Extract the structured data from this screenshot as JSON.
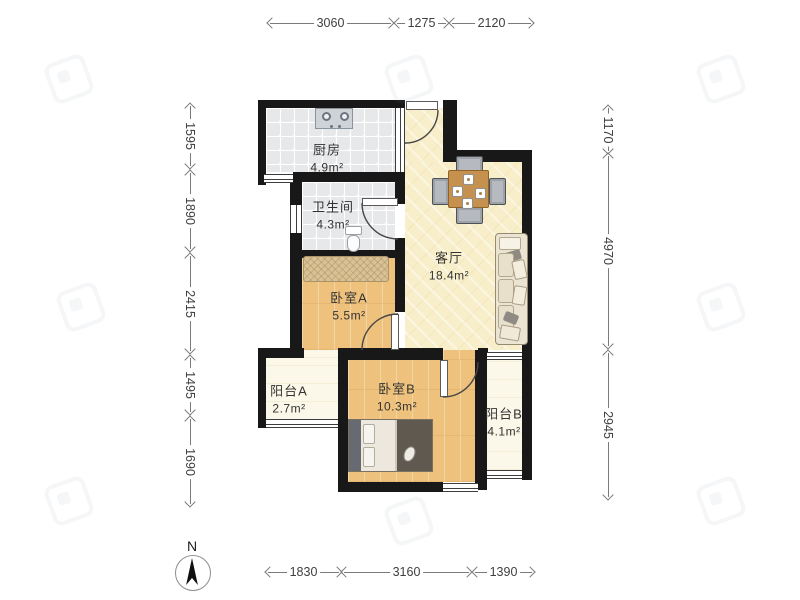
{
  "rooms": {
    "kitchen": {
      "name": "厨房",
      "area": "4.9m²"
    },
    "bathroom": {
      "name": "卫生间",
      "area": "4.3m²"
    },
    "living": {
      "name": "客厅",
      "area": "18.4m²"
    },
    "bedroomA": {
      "name": "卧室A",
      "area": "5.5m²"
    },
    "bedroomB": {
      "name": "卧室B",
      "area": "10.3m²"
    },
    "balconyA": {
      "name": "阳台A",
      "area": "2.7m²"
    },
    "balconyB": {
      "name": "阳台B",
      "area": "4.1m²"
    }
  },
  "dimensions": {
    "top": [
      {
        "label": "3060"
      },
      {
        "label": "1275"
      },
      {
        "label": "2120"
      }
    ],
    "left": [
      {
        "label": "1595"
      },
      {
        "label": "1890"
      },
      {
        "label": "2415"
      },
      {
        "label": "1495"
      },
      {
        "label": "1690"
      }
    ],
    "right": [
      {
        "label": "1170"
      },
      {
        "label": "4970"
      },
      {
        "label": "2945"
      }
    ],
    "bottom": [
      {
        "label": "1830"
      },
      {
        "label": "3160"
      },
      {
        "label": "1390"
      }
    ]
  },
  "compass": {
    "label": "N"
  },
  "colors": {
    "wall": "#181818",
    "tile_floor": "#e7e8ea",
    "living_floor": "#f8efca",
    "wood_floor": "#eec27c",
    "balcony_floor": "#fbf7e9",
    "table": "#c6904f",
    "dimension_text": "#3f3f3f"
  }
}
